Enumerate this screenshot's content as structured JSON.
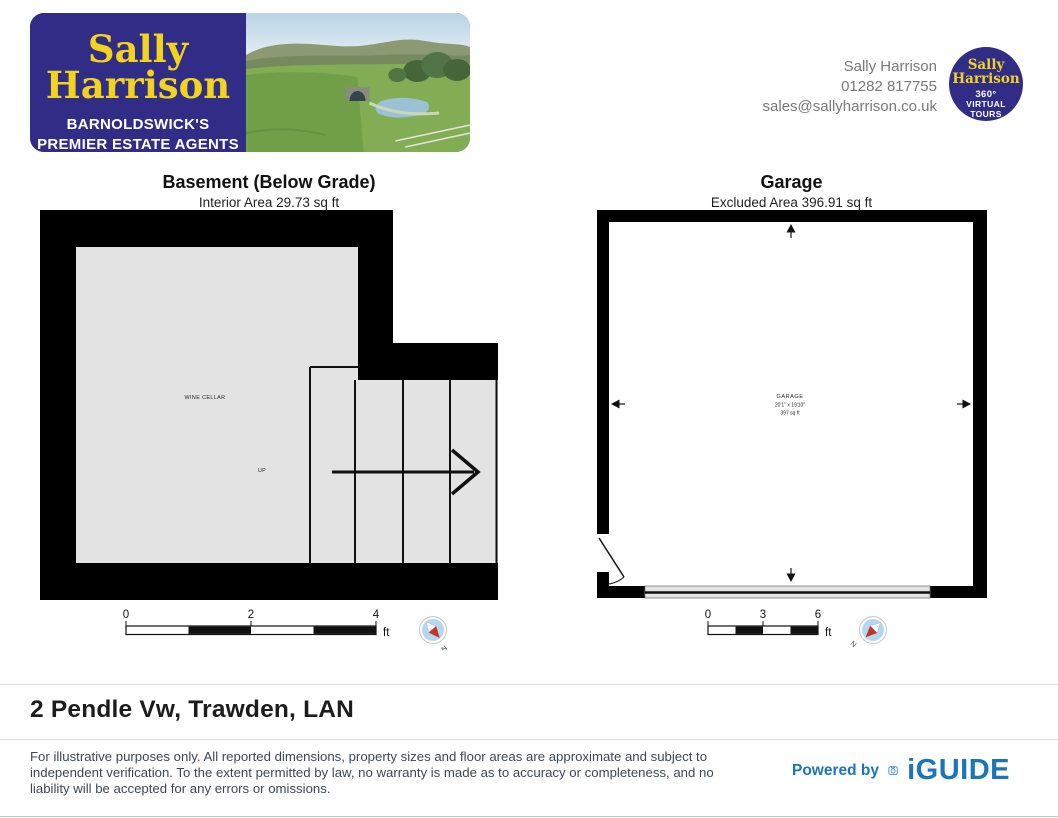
{
  "header": {
    "logo": {
      "name_line1": "Sally",
      "name_line2": "Harrison",
      "tagline_line1": "BARNOLDSWICK'S",
      "tagline_line2": "PREMIER ESTATE AGENTS"
    },
    "contact": {
      "name": "Sally Harrison",
      "phone": "01282 817755",
      "email": "sales@sallyharrison.co.uk"
    },
    "badge": {
      "name_line1": "Sally",
      "name_line2": "Harrison",
      "sub_line1": "360°",
      "sub_line2": "VIRTUAL",
      "sub_line3": "TOURS"
    }
  },
  "floorplans": {
    "basement": {
      "title": "Basement (Below Grade)",
      "subtitle": "Interior Area 29.73 sq ft",
      "room_label": "WINE CELLAR",
      "stairs_label": "UP",
      "scale_ticks": [
        "0",
        "2",
        "4"
      ],
      "scale_unit": "ft",
      "compass_label": "N"
    },
    "garage": {
      "title": "Garage",
      "subtitle": "Excluded Area 396.91 sq ft",
      "room_label": "GARAGE",
      "room_dimensions": "20'1\" x 19'10\"",
      "room_area": "397 sq ft",
      "scale_ticks": [
        "0",
        "3",
        "6"
      ],
      "scale_unit": "ft",
      "compass_label": "N"
    }
  },
  "footer": {
    "address": "2 Pendle Vw, Trawden, LAN",
    "disclaimer": "For illustrative purposes only. All reported dimensions, property sizes and floor areas are approximate and subject to independent verification. To the extent permitted by law, no warranty is made as to accuracy or completeness, and no liability will be accepted for any errors or omissions.",
    "powered_by_label": "Powered by",
    "iguide_label": "iGUIDE"
  },
  "colors": {
    "brand_blue": "#312c85",
    "brand_yellow": "#f2d41f",
    "iguide_blue": "#1b75bb",
    "wall_black": "#000000",
    "floor_gray": "#e3e3e3",
    "compass_blue": "#b5d8ee",
    "compass_red": "#c53428"
  }
}
